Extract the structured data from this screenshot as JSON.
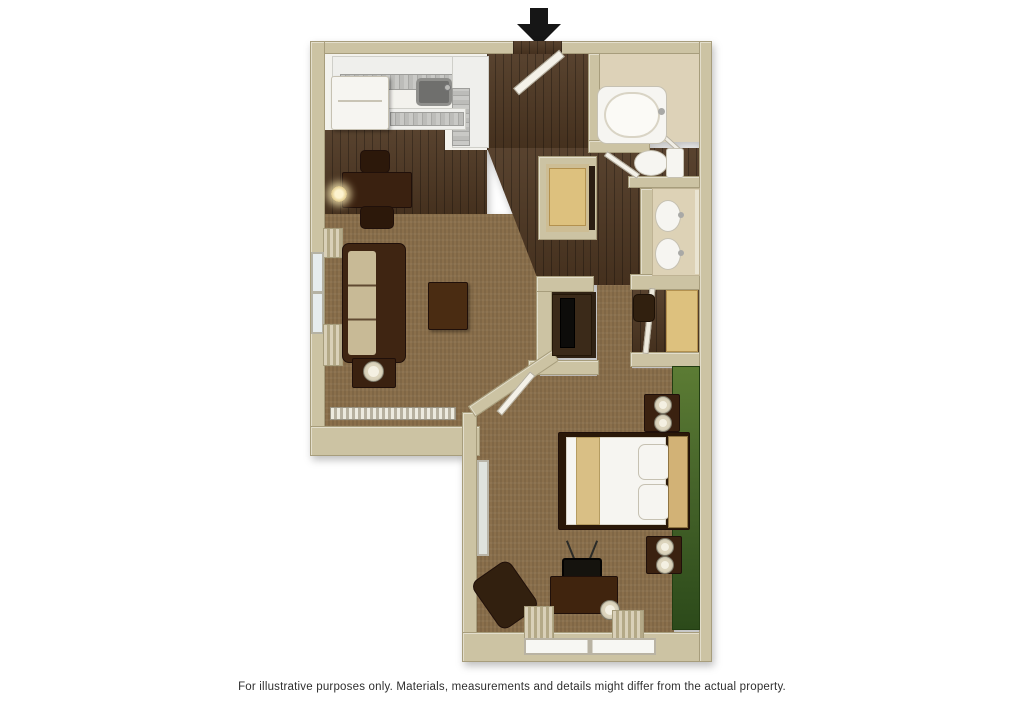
{
  "disclaimer": "For illustrative purposes only.  Materials, measurements and details might differ from the actual property.",
  "entrance_arrow": {
    "direction": "down",
    "color": "#161616"
  },
  "palette": {
    "background": "#ffffff",
    "wall": "#ccc3a3",
    "wall_edge": "#a79d7c",
    "wood_floor": "#4e3722",
    "carpet": "#8a6f4b",
    "kitchen_floor": "#f3f2ed",
    "bath_floor": "#ddd2b8",
    "counter_gray": "#c1c1be",
    "accent_wall_green": "#46642a",
    "tan_wood": "#ddc17e",
    "dark_furniture": "#3a2110",
    "white_fixture": "#f6f5f1"
  },
  "floorplan": {
    "style": "3d-top-down-render",
    "rooms": [
      "kitchen",
      "dining-area",
      "entry",
      "living-room",
      "bathroom",
      "toilet-area",
      "vanity-area",
      "linen-closet",
      "hallway",
      "walk-in-closet",
      "media-niche",
      "bedroom"
    ],
    "furniture": [
      {
        "item": "refrigerator",
        "room": "kitchen"
      },
      {
        "item": "l-shaped-counter-with-sink",
        "room": "kitchen"
      },
      {
        "item": "dining-table",
        "room": "dining-area",
        "chairs": 2
      },
      {
        "item": "wall-sconce",
        "room": "dining-area"
      },
      {
        "item": "entry-door",
        "room": "entry",
        "state": "open"
      },
      {
        "item": "sofa",
        "room": "living-room"
      },
      {
        "item": "coffee-table",
        "room": "living-room"
      },
      {
        "item": "end-table-with-lamp",
        "room": "living-room"
      },
      {
        "item": "window-with-curtains",
        "room": "living-room"
      },
      {
        "item": "baseboard-heater",
        "room": "living-room"
      },
      {
        "item": "bathtub",
        "room": "bathroom"
      },
      {
        "item": "shower-door",
        "room": "bathroom"
      },
      {
        "item": "toilet",
        "room": "toilet-area"
      },
      {
        "item": "double-sink-vanity",
        "room": "vanity-area",
        "sinks": 2
      },
      {
        "item": "shelving",
        "room": "linen-closet"
      },
      {
        "item": "wardrobe",
        "room": "walk-in-closet"
      },
      {
        "item": "hanging-clothes",
        "room": "walk-in-closet"
      },
      {
        "item": "mirrored-door",
        "room": "walk-in-closet"
      },
      {
        "item": "tv-cabinet",
        "room": "media-niche"
      },
      {
        "item": "bed-with-pillows",
        "room": "bedroom"
      },
      {
        "item": "nightstand-with-lamps",
        "room": "bedroom",
        "count": 2
      },
      {
        "item": "dresser-with-tv-antenna",
        "room": "bedroom"
      },
      {
        "item": "lounge-chair",
        "room": "bedroom"
      },
      {
        "item": "standing-mirror",
        "room": "bedroom"
      },
      {
        "item": "floor-lamp",
        "room": "bedroom"
      },
      {
        "item": "window-with-curtains",
        "room": "bedroom"
      },
      {
        "item": "green-accent-wall",
        "room": "bedroom"
      }
    ]
  }
}
